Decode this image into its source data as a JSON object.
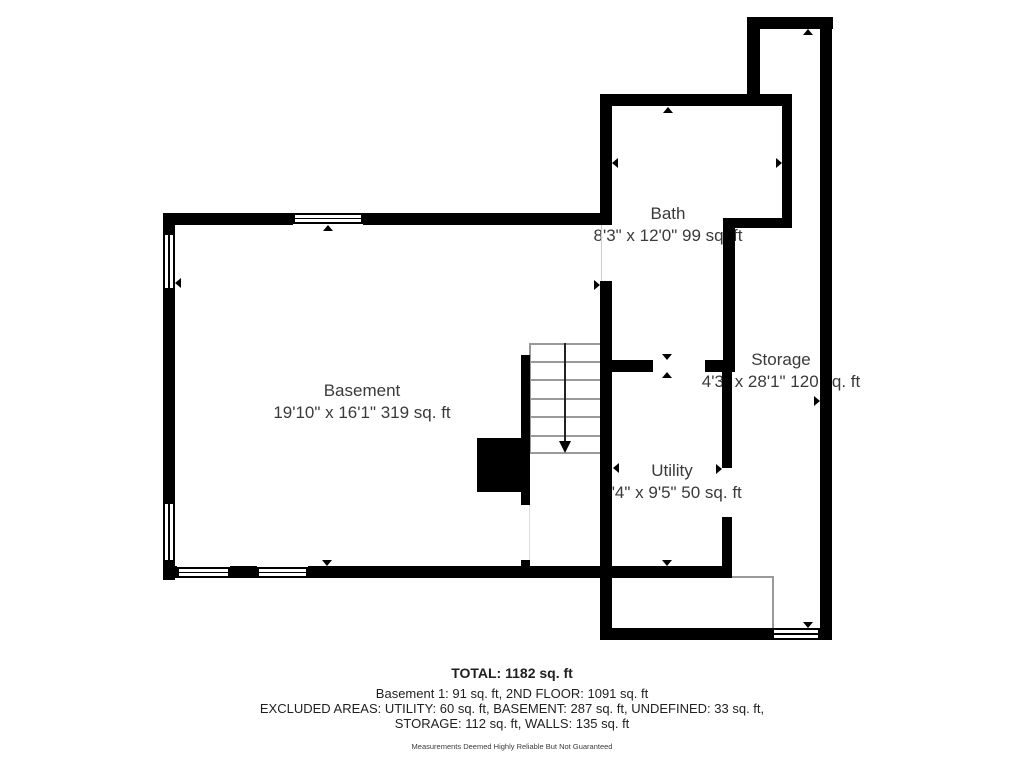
{
  "rooms": [
    {
      "name": "Basement",
      "dims": "19'10\" x 16'1\" 319 sq. ft"
    },
    {
      "name": "Bath",
      "dims": "8'3\" x 12'0\" 99 sq. ft"
    },
    {
      "name": "Storage",
      "dims": "4'3\" x 28'1\" 120 sq. ft"
    },
    {
      "name": "Utility",
      "dims": "5'4\" x 9'5\" 50 sq. ft"
    }
  ],
  "summary": {
    "total": "TOTAL: 1182 sq. ft",
    "line2": "Basement 1: 91 sq. ft, 2ND FLOOR: 1091 sq. ft",
    "line3": "EXCLUDED AREAS: UTILITY: 60 sq. ft, BASEMENT: 287 sq. ft, UNDEFINED: 33 sq. ft,",
    "line4": "STORAGE: 112 sq. ft, WALLS: 135 sq. ft",
    "disclaimer": "Measurements Deemed Highly Reliable But Not Guaranteed"
  },
  "colors": {
    "wall": "#000000",
    "background": "#ffffff",
    "construction_line": "#9a9a9a",
    "label_text": "#3a3a3a",
    "summary_text": "#1f1f1f"
  }
}
